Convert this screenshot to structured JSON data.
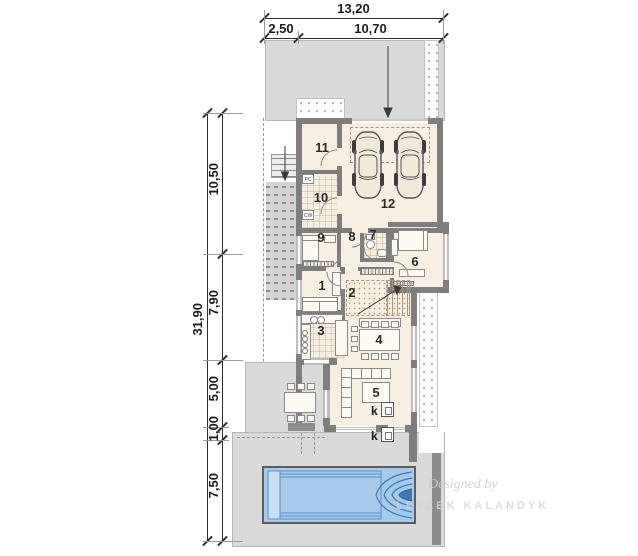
{
  "dimensions": {
    "top": {
      "total": "13,20",
      "seg1": "2,50",
      "seg2": "10,70"
    },
    "left": {
      "total": "31,90",
      "seg1": "10,50",
      "seg2": "7,90",
      "seg3": "5,00",
      "seg4": "1,00",
      "seg5": "7,50"
    }
  },
  "rooms": {
    "r1": "1",
    "r2": "2",
    "r3": "3",
    "r4": "4",
    "r5": "5",
    "r6": "6",
    "r7": "7",
    "r8": "8",
    "r9": "9",
    "r10": "10",
    "r11": "11",
    "r12": "12"
  },
  "equipment": {
    "pc": "PC",
    "cw": "CW",
    "fireplace_inner": "k",
    "fireplace_outer": "k"
  },
  "watermark": {
    "credit": "Designed by",
    "author": "LESZEK KALANDYK"
  },
  "colors": {
    "site": "#dadada",
    "wall": "#7e7e7e",
    "floor": "#f6efe2",
    "pool_fill": "#a6cbea",
    "pool_line": "#3f77b3",
    "dim_text": "#1c1c1c"
  }
}
